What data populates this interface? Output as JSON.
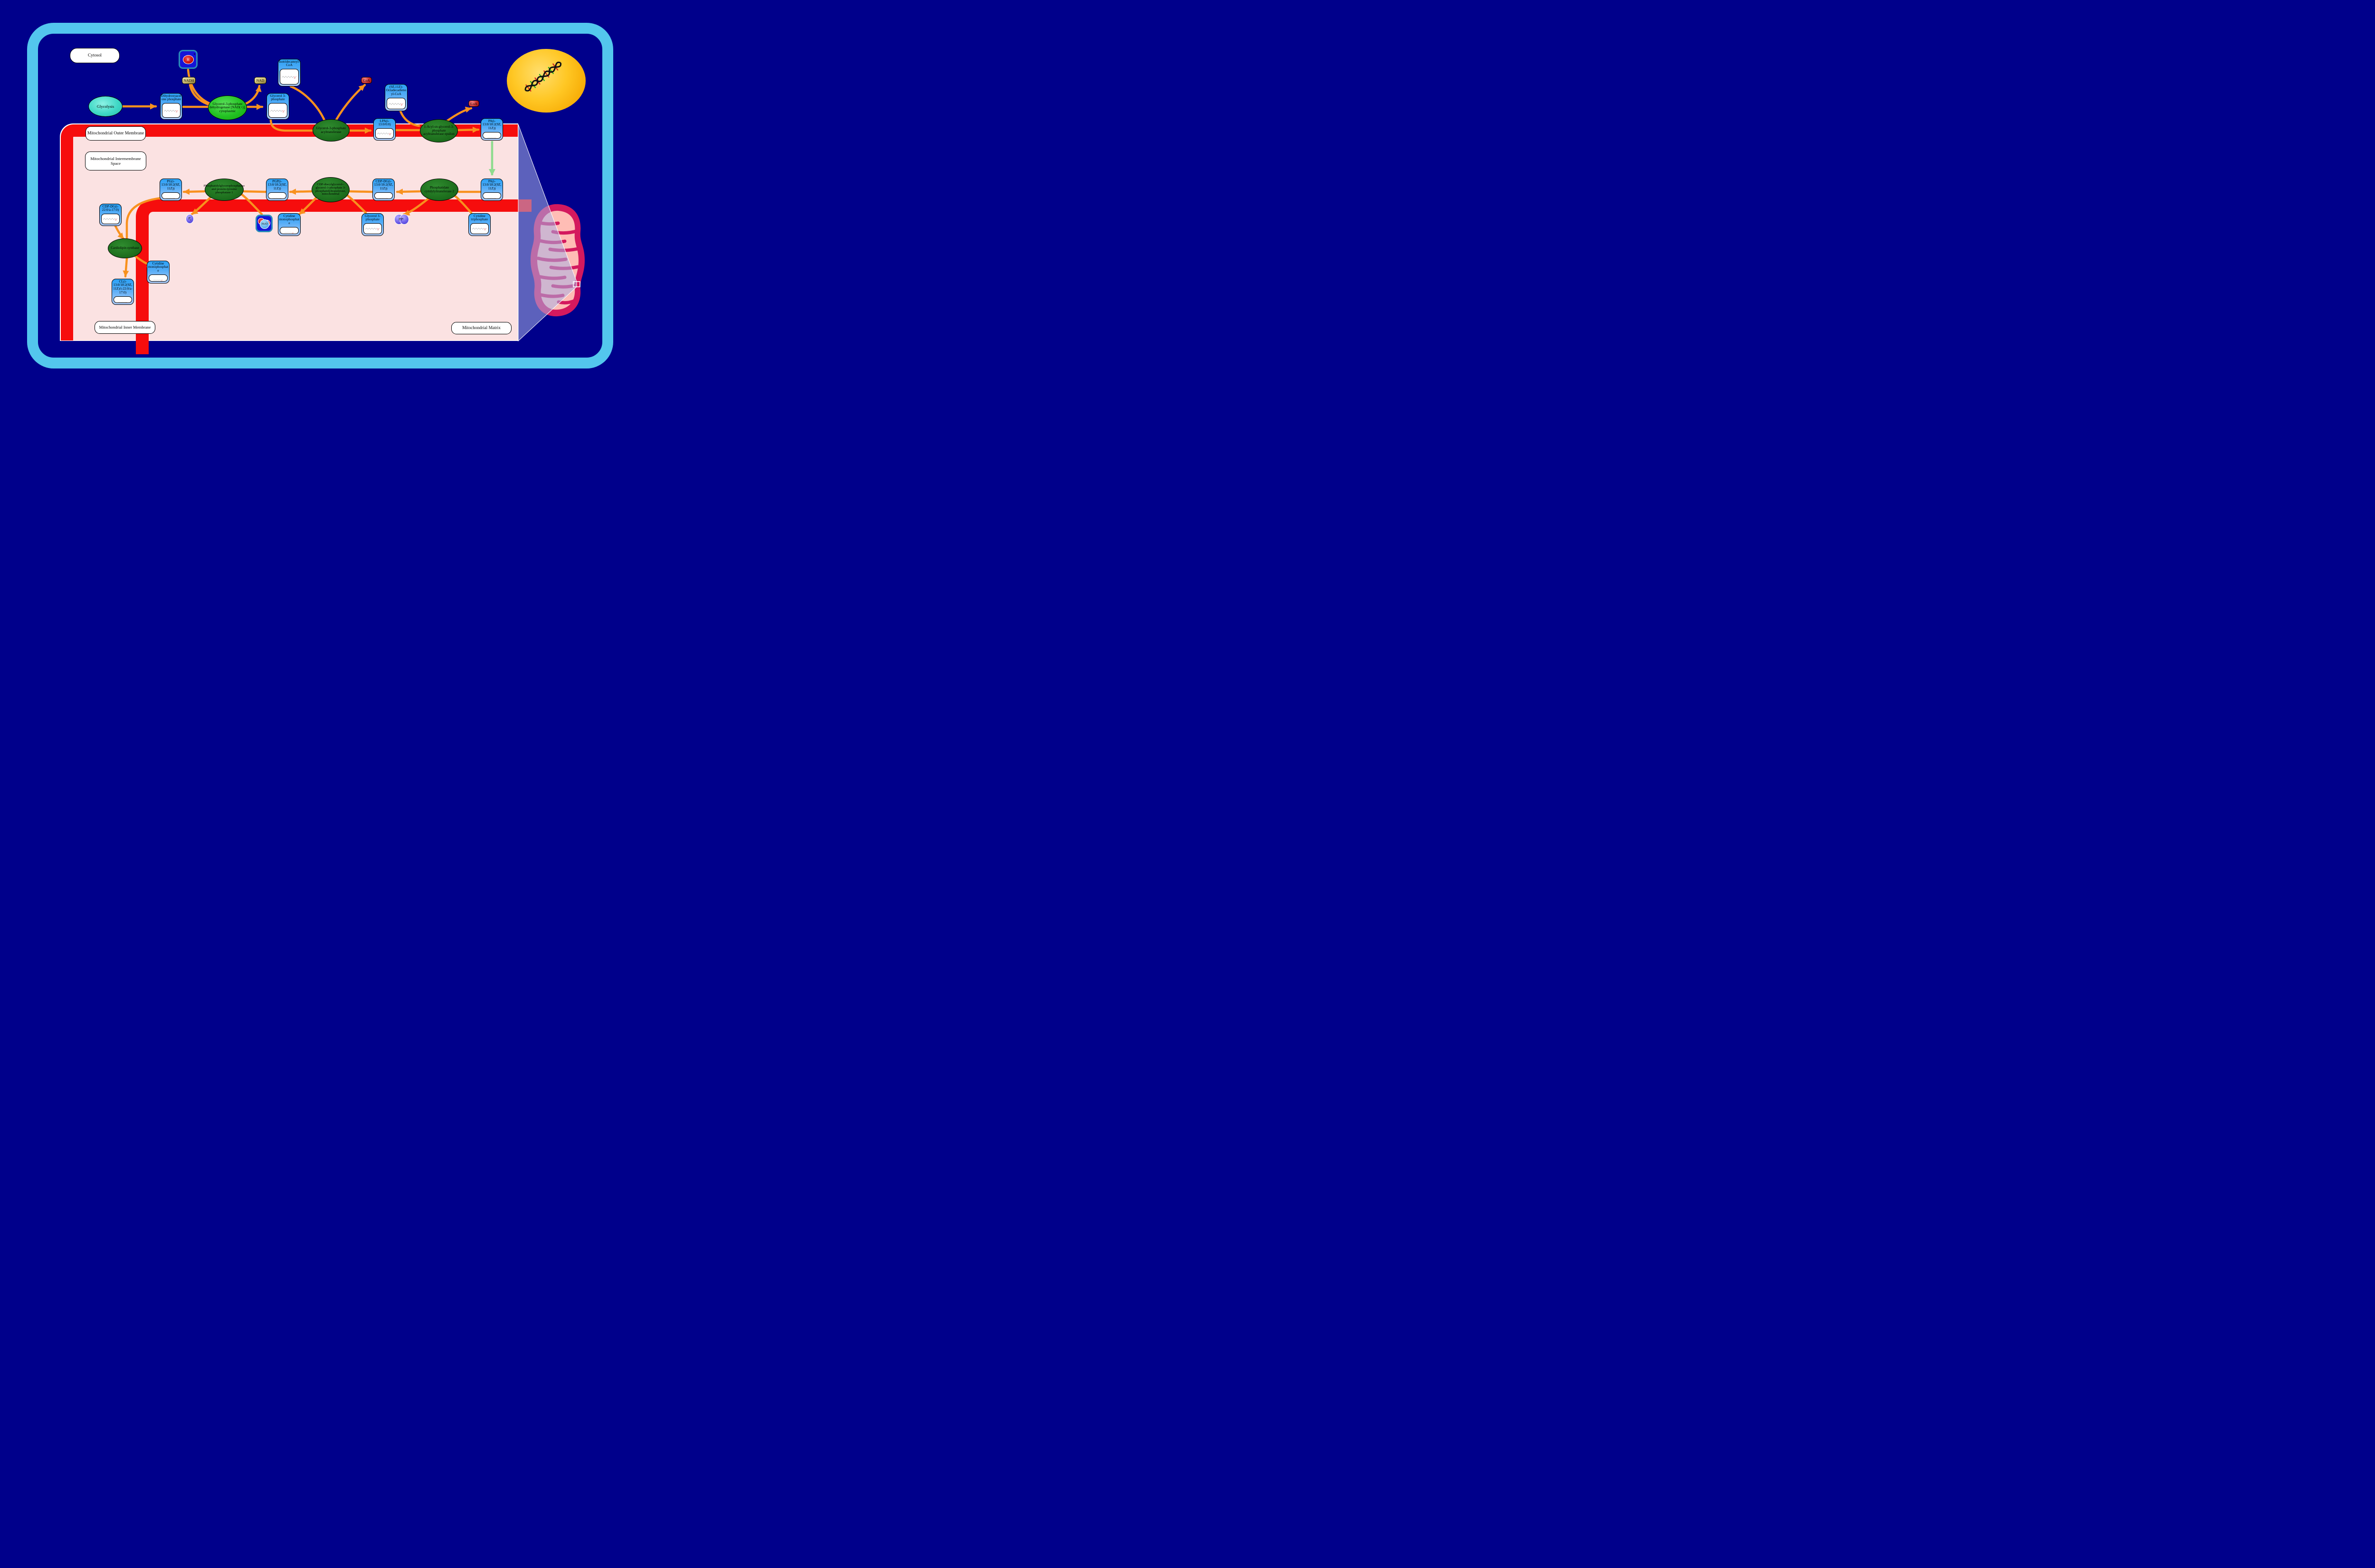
{
  "labels": {
    "cytosol": "Cytosol",
    "outer_membrane": "Mitochondrial Outer Membrane",
    "intermembrane_space": "Mitochondrial Intermembrane Space",
    "inner_membrane": "Mitochondrial Inner Membrane",
    "matrix": "Mitochondrial Matrix"
  },
  "pathway": {
    "glycolysis": {
      "label": "Glycolysis"
    }
  },
  "enzymes": {
    "gpd": {
      "label": "Glycerol-3-phosphate dehydrogenase [NAD(+)], cytoplasmic"
    },
    "gpat": {
      "label": "Glycerol-3-phosphate acyltransferase"
    },
    "agpat": {
      "label": "1-Acyl-sn-glycerol-3-phosphate acyltransferase epsilon"
    },
    "pcyt2": {
      "label": "Phosphatidate cytidylyltransferase 2"
    },
    "cds": {
      "label": "CDP-diacylglycerol--glycerol-3-phosphate 3-phosphatidyltransferase, mitochondrial"
    },
    "ptpmt1": {
      "label": "Phosphatidylglycerophosphatase and protein-tyrosine phosphatase 1"
    },
    "cls": {
      "label": "Cardiolipin synthase"
    }
  },
  "metabolites": {
    "dhap": {
      "label": "Dihydroxyacetone phosphate"
    },
    "g3p_top": {
      "label": "Glycerol 3-phosphate"
    },
    "iso_coa": {
      "label": "Isotridecanoyl-CoA"
    },
    "octa_coa": {
      "label": "(9Z,11Z)-Octadecadienoyl-CoA"
    },
    "lpa": {
      "label": "LPA(i-13:0/0:0)"
    },
    "pa_top": {
      "label": "PA(i-13:0/18:2(9Z,11Z))"
    },
    "pa_bottom": {
      "label": "PA(i-13:0/18:2(9Z,11Z))"
    },
    "cdp_dg_right": {
      "label": "CDP-DG(i-13:0/18:2(9Z,11Z))"
    },
    "pgp": {
      "label": "PGP(i-13:0/18:2(9Z,11Z))"
    },
    "pg": {
      "label": "PG(i-13:0/18:2(9Z,11Z))"
    },
    "cdp_dg_left": {
      "label": "CDP-DG(i-22:0/a-17:0)"
    },
    "cl": {
      "label": "CL(i-13:0/18:2(9Z,11Z)/i-22:0/a-17:0)"
    },
    "cmp_mid": {
      "label": "Cytidine monophosphate"
    },
    "cmp_bottom": {
      "label": "Cytidine monophosphate"
    },
    "g3p_mid": {
      "label": "Glycerol 3-phosphate"
    },
    "ctp": {
      "label": "Cytidine triphosphate"
    }
  },
  "small": {
    "nadh": "NADH",
    "nad": "NAD",
    "coa_top": "CoA",
    "coa_right": "CoA",
    "h_plus": {
      "symbol": "H",
      "charge": "+"
    },
    "h2o": {
      "h": "H",
      "two": "2",
      "o": "O"
    },
    "pi": {
      "base": "P",
      "sub": "i"
    },
    "ppi": {
      "base": "PP",
      "sub": "i"
    }
  },
  "colors": {
    "background_navy": "#00008B",
    "cell_frame_blue": "#53C6ED",
    "membrane_red": "#F60D0D",
    "panel_pink": "#FBE2E2",
    "arrow_orange": "#F8911E",
    "transport_arrow_green": "#8FDB8F",
    "metabolite_box_blue": "#2BA1F6",
    "enzyme_green_dark": "#1E701E",
    "enzyme_green_bright": "#23C223",
    "pathway_teal": "#40D8C6",
    "nucleus_yellow": "#FFC724",
    "mitochondrion_crimson": "#D4195E",
    "mitochondrion_salmon": "#FFBDB5"
  }
}
